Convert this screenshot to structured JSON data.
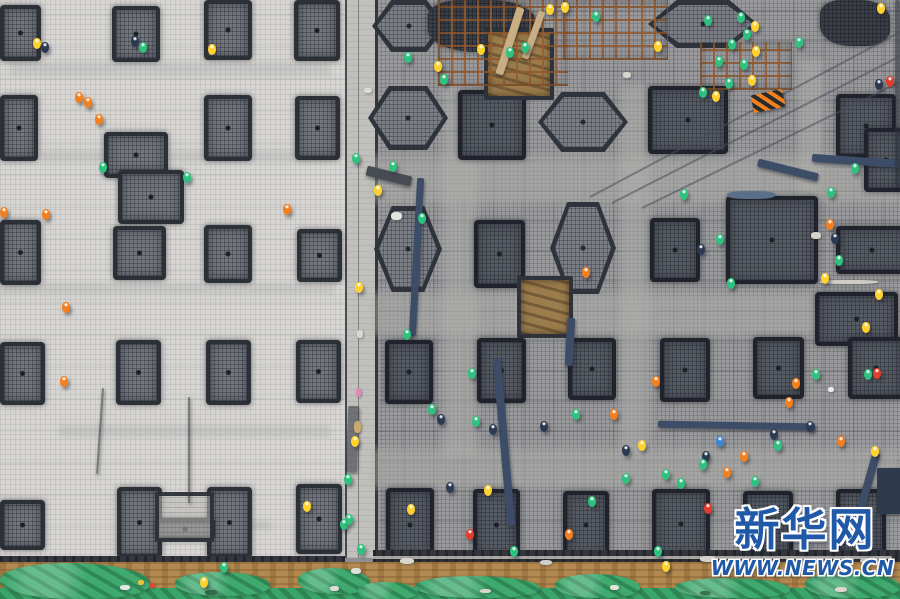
{
  "watermark": {
    "brand": "新华网",
    "url": "WWW.NEWS.CN"
  },
  "palette": {
    "slab_left": "#d7d5d1",
    "mesh_right": "#9a9a9c",
    "divider": "#c1c0bc",
    "pad_border": "#2e323a",
    "pad_left_fill": "#73767d",
    "pad_right_fill": "#565a62",
    "hex_fill": "#7b7e85",
    "pit_fill": "#9b7c4c",
    "scaffold_rust": "#965c30",
    "trench": "#33363c",
    "dirt": "#b3894f",
    "tarp_green": "#3aa569",
    "watermark_blue": "#2059a8",
    "workers": {
      "o": "#f57e1d",
      "y": "#ffd22e",
      "g": "#2ec27e",
      "b": "#3f85d6",
      "r": "#e23c2a",
      "d": "#2b3a52",
      "w": "#eef0f2"
    },
    "beams": {
      "navy": "#3d4d68",
      "dark": "#474b52",
      "smoke": "rgba(45,49,56,0.55)",
      "plank": "#c9ae83",
      "rail": "rgba(207,204,196,0.75)",
      "block": "#2e3a4e"
    }
  },
  "scene": {
    "left_pads": [
      [
        0,
        5,
        33,
        48
      ],
      [
        112,
        6,
        40,
        48
      ],
      [
        204,
        0,
        40,
        52
      ],
      [
        294,
        0,
        38,
        53
      ],
      [
        0,
        95,
        30,
        58
      ],
      [
        204,
        95,
        40,
        58
      ],
      [
        295,
        96,
        37,
        56
      ],
      [
        104,
        132,
        56,
        38
      ],
      [
        118,
        170,
        58,
        46
      ],
      [
        0,
        220,
        33,
        57
      ],
      [
        113,
        226,
        45,
        46
      ],
      [
        204,
        225,
        40,
        50
      ],
      [
        297,
        229,
        37,
        45
      ],
      [
        0,
        342,
        37,
        55
      ],
      [
        116,
        340,
        37,
        57
      ],
      [
        206,
        340,
        37,
        57
      ],
      [
        296,
        340,
        37,
        55
      ],
      [
        0,
        500,
        37,
        42
      ],
      [
        117,
        487,
        37,
        63
      ],
      [
        207,
        487,
        37,
        63
      ],
      [
        296,
        484,
        38,
        62
      ],
      [
        155,
        518,
        52,
        14
      ]
    ],
    "left_frame": [
      155,
      492,
      51,
      42
    ],
    "right_shapes": [
      [
        "hex",
        372,
        0,
        74,
        52
      ],
      [
        "blob",
        428,
        0,
        108,
        52
      ],
      [
        "hex",
        648,
        0,
        110,
        48
      ],
      [
        "blob",
        820,
        0,
        70,
        46
      ],
      [
        "hex",
        368,
        86,
        80,
        64
      ],
      [
        "rect",
        458,
        90,
        60,
        62
      ],
      [
        "hex",
        538,
        92,
        90,
        60
      ],
      [
        "rect",
        648,
        86,
        72,
        60
      ],
      [
        "rect",
        836,
        94,
        52,
        56
      ],
      [
        "rect",
        864,
        128,
        36,
        56
      ],
      [
        "pit",
        484,
        28,
        62,
        64
      ],
      [
        "hex",
        374,
        206,
        68,
        86
      ],
      [
        "rect",
        474,
        220,
        43,
        60
      ],
      [
        "hex",
        550,
        202,
        66,
        92
      ],
      [
        "rect",
        650,
        218,
        42,
        56
      ],
      [
        "rect",
        726,
        196,
        84,
        80
      ],
      [
        "rect",
        836,
        226,
        64,
        40
      ],
      [
        "rect",
        815,
        292,
        75,
        46
      ],
      [
        "pit",
        517,
        276,
        48,
        54
      ],
      [
        "rect",
        385,
        340,
        40,
        56
      ],
      [
        "rect",
        477,
        338,
        41,
        57
      ],
      [
        "rect",
        568,
        338,
        40,
        54
      ],
      [
        "rect",
        660,
        338,
        42,
        56
      ],
      [
        "rect",
        753,
        337,
        43,
        54
      ],
      [
        "rect",
        848,
        337,
        48,
        54
      ],
      [
        "rect",
        386,
        488,
        40,
        66
      ],
      [
        "rect",
        473,
        489,
        39,
        64
      ],
      [
        "rect",
        563,
        491,
        38,
        60
      ],
      [
        "rect",
        652,
        489,
        50,
        62
      ],
      [
        "rect",
        743,
        491,
        42,
        59
      ],
      [
        "rect",
        836,
        489,
        42,
        60
      ]
    ],
    "scaffolds": [
      [
        438,
        0,
        130,
        86
      ],
      [
        563,
        0,
        105,
        60
      ],
      [
        700,
        42,
        92,
        48
      ]
    ],
    "corridors": [
      [
        372,
        155,
        528,
        48
      ],
      [
        372,
        293,
        528,
        42
      ],
      [
        372,
        448,
        528,
        40
      ],
      [
        443,
        85,
        34,
        372
      ],
      [
        620,
        85,
        30,
        370
      ],
      [
        798,
        60,
        26,
        132
      ]
    ],
    "smudges": [
      [
        10,
        62,
        320,
        14
      ],
      [
        40,
        150,
        290,
        12
      ],
      [
        0,
        283,
        335,
        12
      ],
      [
        60,
        425,
        270,
        12
      ],
      [
        150,
        520,
        120,
        10
      ]
    ],
    "beams": [
      [
        413,
        178,
        7,
        158,
        3,
        "navy"
      ],
      [
        500,
        358,
        8,
        168,
        -5,
        "navy"
      ],
      [
        566,
        318,
        8,
        48,
        3,
        "navy"
      ],
      [
        658,
        422,
        157,
        7,
        1,
        "navy"
      ],
      [
        757,
        166,
        62,
        8,
        14,
        "navy"
      ],
      [
        812,
        157,
        92,
        8,
        4,
        "navy"
      ],
      [
        864,
        452,
        8,
        62,
        16,
        "navy"
      ],
      [
        877,
        468,
        24,
        46,
        0,
        "block"
      ],
      [
        366,
        171,
        46,
        10,
        14,
        "dark"
      ],
      [
        347,
        406,
        11,
        66,
        2,
        "smoke"
      ],
      [
        506,
        6,
        8,
        70,
        18,
        "plank"
      ],
      [
        530,
        10,
        7,
        50,
        20,
        "plank"
      ],
      [
        372,
        556,
        520,
        3,
        0,
        "rail"
      ],
      [
        188,
        397,
        2,
        106,
        0,
        "smoke"
      ],
      [
        99,
        388,
        2,
        86,
        4,
        "smoke"
      ],
      [
        895,
        0,
        5,
        185,
        0,
        "smoke"
      ]
    ],
    "cables": [
      [
        590,
        196,
        358,
        -28
      ],
      [
        612,
        202,
        332,
        -27
      ],
      [
        642,
        207,
        302,
        -26
      ]
    ],
    "barrier": [
      752,
      92,
      32,
      18,
      -12
    ],
    "green_patches": [
      [
        0,
        563,
        150,
        36
      ],
      [
        175,
        572,
        95,
        24
      ],
      [
        298,
        568,
        72,
        26
      ],
      [
        415,
        576,
        125,
        22
      ],
      [
        555,
        574,
        85,
        24
      ],
      [
        675,
        578,
        115,
        20
      ],
      [
        805,
        572,
        95,
        26
      ],
      [
        358,
        582,
        60,
        18
      ]
    ],
    "debris": [
      [
        811,
        232,
        10,
        7,
        "#d8d3c8"
      ],
      [
        391,
        212,
        11,
        8,
        "#e4e2dc"
      ],
      [
        828,
        387,
        6,
        5,
        "#ececec"
      ],
      [
        727,
        191,
        48,
        8,
        "#5b6f8a"
      ],
      [
        820,
        280,
        58,
        4,
        "#cfccc4"
      ],
      [
        364,
        88,
        8,
        5,
        "#dcdcd6"
      ],
      [
        357,
        330,
        6,
        8,
        "#d8d8d2"
      ],
      [
        356,
        388,
        5,
        9,
        "#e08ab2"
      ],
      [
        354,
        421,
        7,
        12,
        "#c9a96d"
      ],
      [
        351,
        568,
        10,
        6,
        "#e0e0da"
      ],
      [
        400,
        558,
        14,
        6,
        "#d9d6cd"
      ],
      [
        540,
        560,
        12,
        5,
        "#ccd0c8"
      ],
      [
        700,
        556,
        16,
        6,
        "#d5d2c9"
      ],
      [
        860,
        558,
        10,
        5,
        "#c9c6bd"
      ],
      [
        138,
        580,
        6,
        5,
        "#e8c23a"
      ],
      [
        149,
        583,
        6,
        5,
        "#d84a35"
      ],
      [
        120,
        585,
        10,
        5,
        "#e8e8e2"
      ],
      [
        205,
        590,
        12,
        5,
        "#2f6b4a"
      ],
      [
        330,
        586,
        9,
        5,
        "#e0ded6"
      ],
      [
        480,
        589,
        11,
        4,
        "#d8d6cc"
      ],
      [
        610,
        585,
        9,
        5,
        "#e6e4da"
      ],
      [
        700,
        591,
        10,
        4,
        "#35744f"
      ],
      [
        835,
        587,
        12,
        5,
        "#ddd9d0"
      ],
      [
        623,
        72,
        8,
        6,
        "#d8d5cc"
      ]
    ],
    "workers": [
      [
        33,
        38,
        "y"
      ],
      [
        41,
        42,
        "d"
      ],
      [
        131,
        36,
        "d"
      ],
      [
        139,
        42,
        "g"
      ],
      [
        208,
        44,
        "y"
      ],
      [
        75,
        92,
        "o"
      ],
      [
        84,
        97,
        "o"
      ],
      [
        95,
        114,
        "o"
      ],
      [
        99,
        162,
        "g"
      ],
      [
        183,
        172,
        "g"
      ],
      [
        0,
        207,
        "o"
      ],
      [
        42,
        209,
        "o"
      ],
      [
        283,
        204,
        "o"
      ],
      [
        62,
        302,
        "o"
      ],
      [
        60,
        376,
        "o"
      ],
      [
        303,
        501,
        "y"
      ],
      [
        340,
        519,
        "g"
      ],
      [
        220,
        562,
        "g"
      ],
      [
        200,
        577,
        "y"
      ],
      [
        352,
        153,
        "g"
      ],
      [
        355,
        282,
        "y"
      ],
      [
        351,
        436,
        "y"
      ],
      [
        345,
        514,
        "g"
      ],
      [
        357,
        544,
        "g"
      ],
      [
        344,
        474,
        "g"
      ],
      [
        404,
        52,
        "g"
      ],
      [
        477,
        44,
        "y"
      ],
      [
        506,
        47,
        "g"
      ],
      [
        434,
        61,
        "y"
      ],
      [
        440,
        74,
        "g"
      ],
      [
        521,
        42,
        "g"
      ],
      [
        546,
        4,
        "y"
      ],
      [
        561,
        2,
        "y"
      ],
      [
        592,
        11,
        "g"
      ],
      [
        654,
        41,
        "y"
      ],
      [
        704,
        15,
        "g"
      ],
      [
        737,
        12,
        "g"
      ],
      [
        751,
        21,
        "y"
      ],
      [
        743,
        29,
        "g"
      ],
      [
        728,
        39,
        "g"
      ],
      [
        752,
        46,
        "y"
      ],
      [
        740,
        59,
        "g"
      ],
      [
        715,
        56,
        "g"
      ],
      [
        748,
        75,
        "y"
      ],
      [
        725,
        78,
        "g"
      ],
      [
        699,
        87,
        "g"
      ],
      [
        712,
        91,
        "y"
      ],
      [
        877,
        3,
        "y"
      ],
      [
        886,
        76,
        "r"
      ],
      [
        875,
        79,
        "d"
      ],
      [
        795,
        37,
        "g"
      ],
      [
        851,
        163,
        "g"
      ],
      [
        827,
        187,
        "g"
      ],
      [
        389,
        161,
        "g"
      ],
      [
        374,
        185,
        "y"
      ],
      [
        418,
        213,
        "g"
      ],
      [
        680,
        189,
        "g"
      ],
      [
        716,
        234,
        "g"
      ],
      [
        697,
        244,
        "d"
      ],
      [
        727,
        278,
        "g"
      ],
      [
        826,
        219,
        "o"
      ],
      [
        831,
        233,
        "d"
      ],
      [
        835,
        255,
        "g"
      ],
      [
        821,
        273,
        "y"
      ],
      [
        875,
        289,
        "y"
      ],
      [
        862,
        322,
        "y"
      ],
      [
        582,
        267,
        "o"
      ],
      [
        403,
        329,
        "g"
      ],
      [
        468,
        368,
        "g"
      ],
      [
        572,
        409,
        "g"
      ],
      [
        610,
        409,
        "o"
      ],
      [
        540,
        421,
        "d"
      ],
      [
        428,
        404,
        "g"
      ],
      [
        437,
        414,
        "d"
      ],
      [
        472,
        416,
        "g"
      ],
      [
        489,
        424,
        "d"
      ],
      [
        652,
        376,
        "o"
      ],
      [
        792,
        378,
        "o"
      ],
      [
        785,
        397,
        "o"
      ],
      [
        812,
        369,
        "g"
      ],
      [
        864,
        369,
        "g"
      ],
      [
        873,
        368,
        "r"
      ],
      [
        806,
        421,
        "d"
      ],
      [
        770,
        429,
        "d"
      ],
      [
        716,
        436,
        "b"
      ],
      [
        774,
        440,
        "g"
      ],
      [
        638,
        440,
        "y"
      ],
      [
        622,
        445,
        "d"
      ],
      [
        702,
        451,
        "d"
      ],
      [
        740,
        451,
        "o"
      ],
      [
        699,
        459,
        "g"
      ],
      [
        723,
        467,
        "o"
      ],
      [
        662,
        469,
        "g"
      ],
      [
        677,
        478,
        "g"
      ],
      [
        751,
        476,
        "g"
      ],
      [
        837,
        436,
        "o"
      ],
      [
        871,
        446,
        "y"
      ],
      [
        446,
        482,
        "d"
      ],
      [
        484,
        485,
        "y"
      ],
      [
        407,
        504,
        "y"
      ],
      [
        565,
        529,
        "o"
      ],
      [
        654,
        546,
        "g"
      ],
      [
        662,
        561,
        "y"
      ],
      [
        588,
        496,
        "g"
      ],
      [
        622,
        473,
        "g"
      ],
      [
        466,
        529,
        "r"
      ],
      [
        510,
        546,
        "g"
      ],
      [
        704,
        503,
        "r"
      ]
    ]
  }
}
